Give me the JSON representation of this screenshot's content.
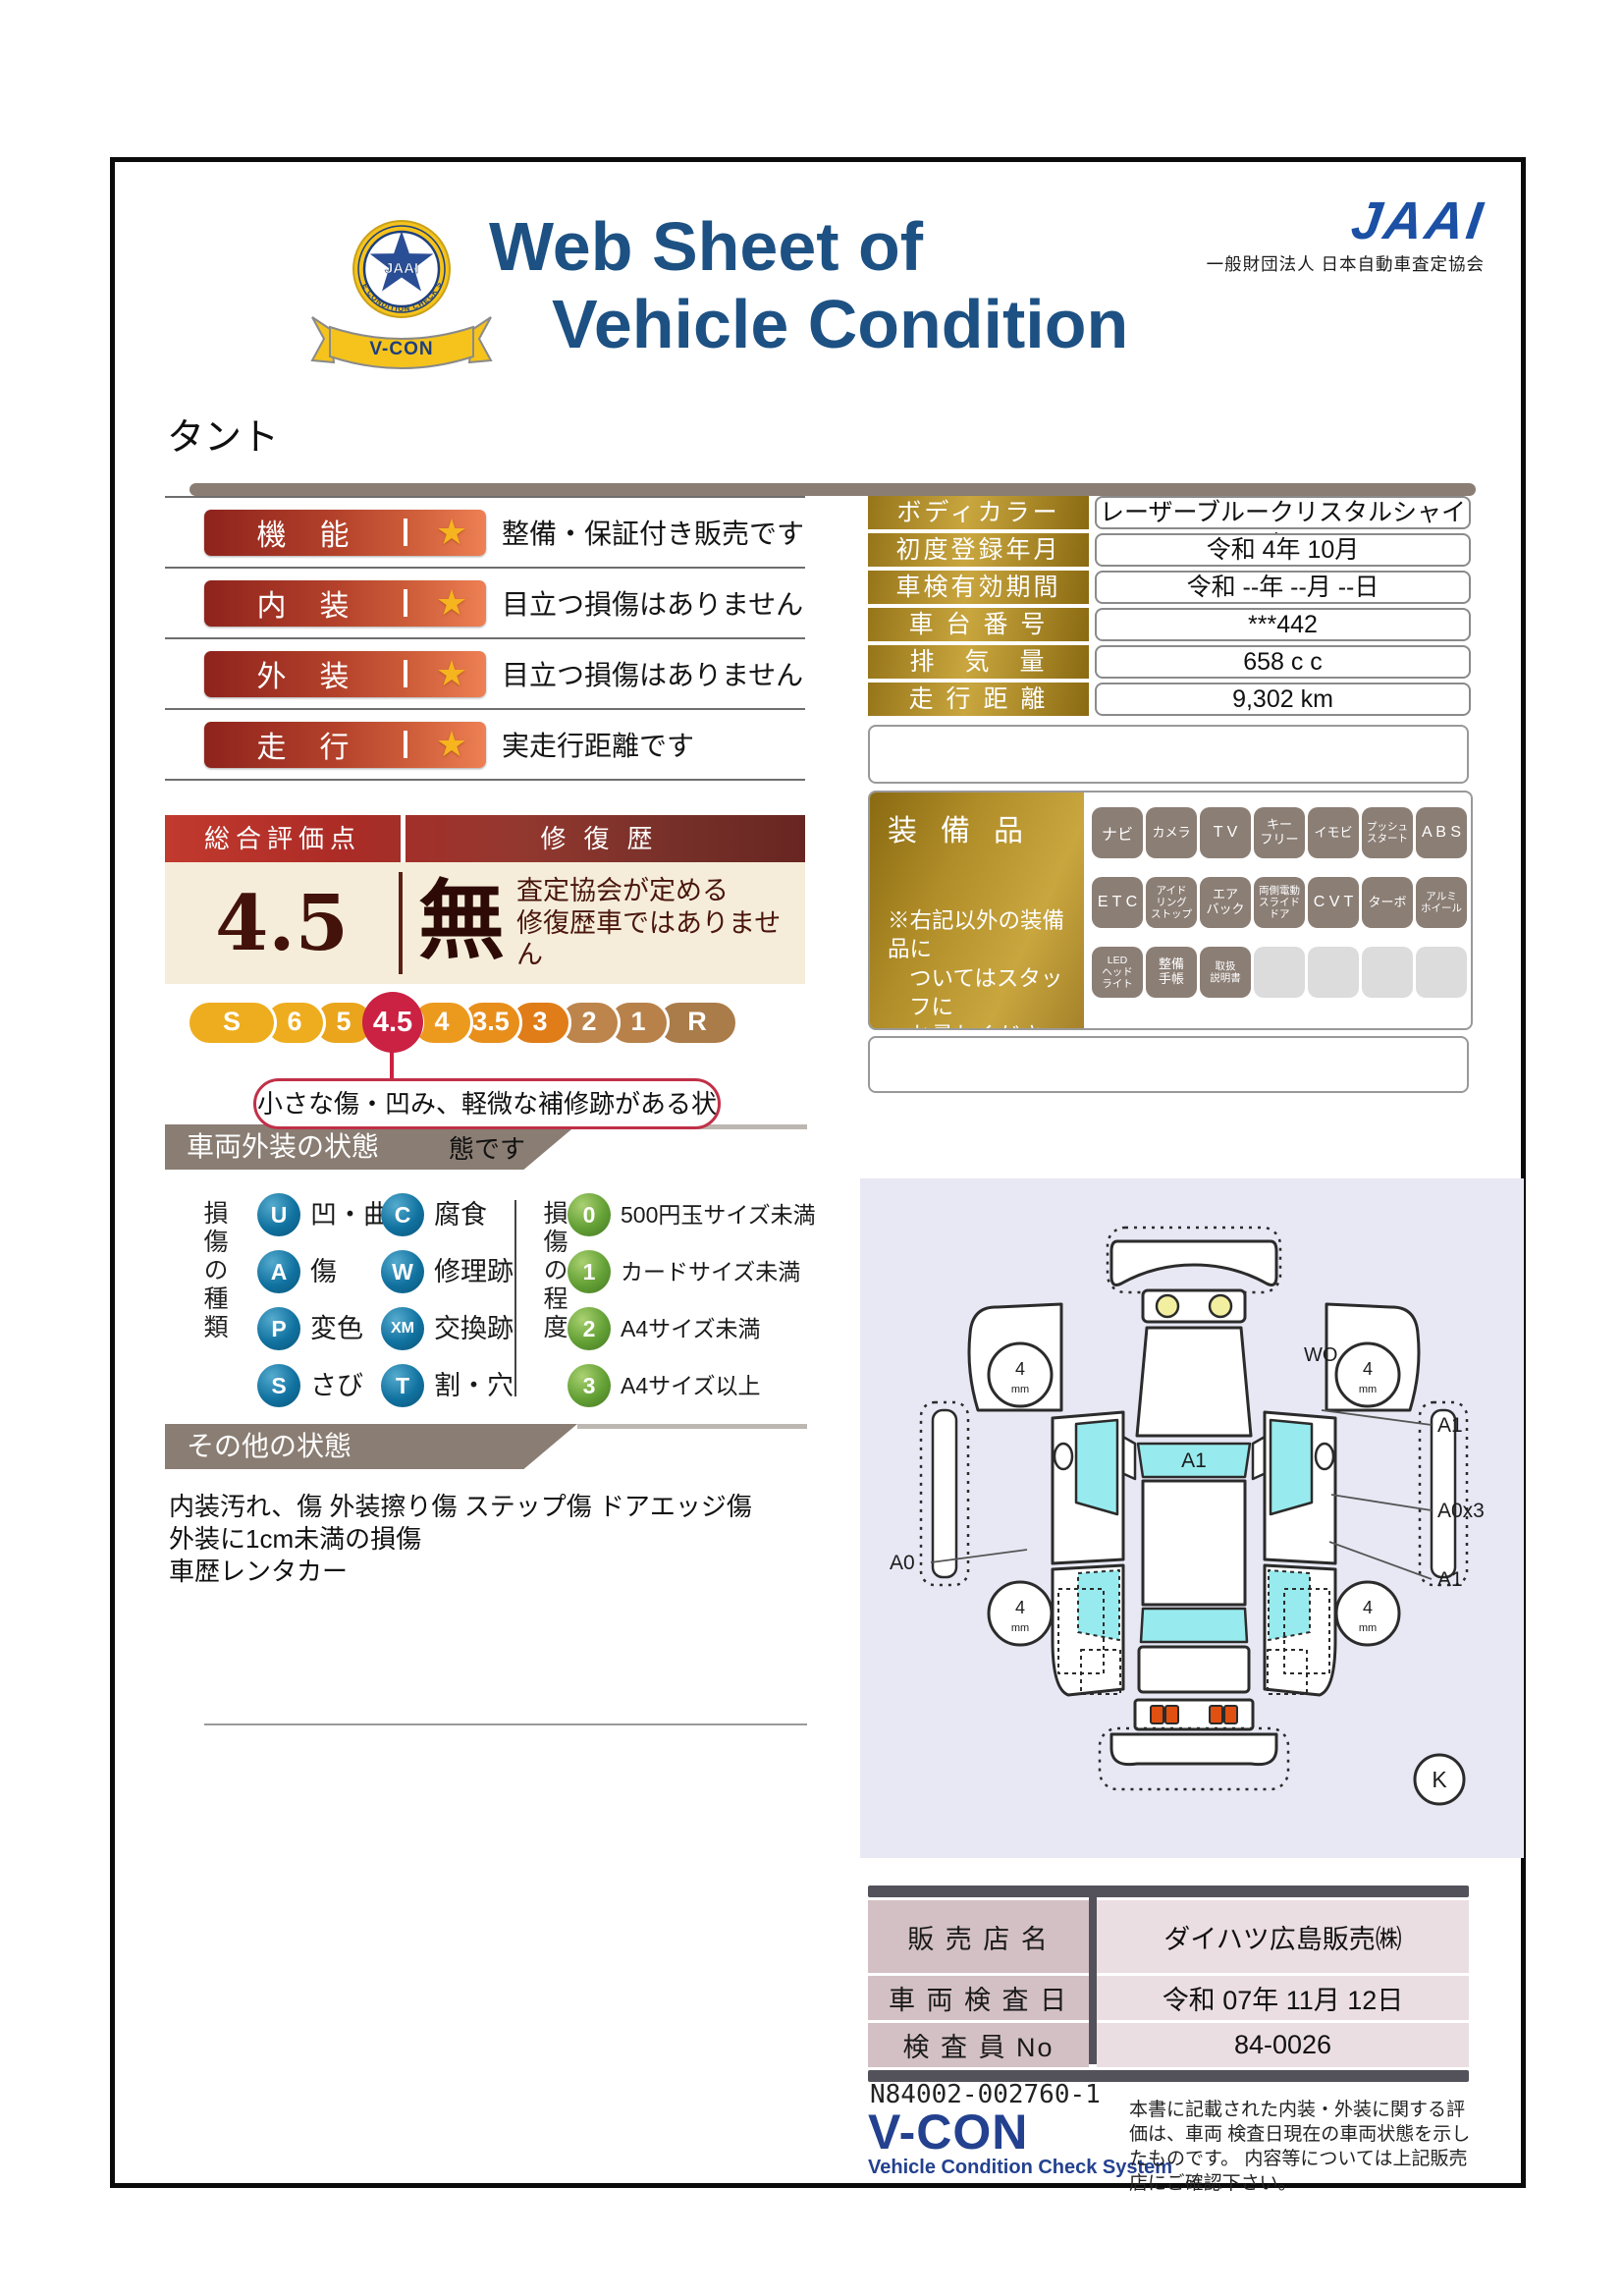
{
  "header": {
    "title_line1": "Web Sheet of",
    "title_line2": "Vehicle Condition",
    "jaai_logo": "JAAI",
    "jaai_org": "一般財団法人 日本自動車査定協会",
    "emblem": {
      "arc_text": "VEHICLE CONDITION CHECK SYSTEM",
      "center_text": "JAAI",
      "ribbon_text": "V-CON"
    }
  },
  "model_name": "タント",
  "icons": {
    "star": "★"
  },
  "ratings": [
    {
      "label": "機　能",
      "description": "整備・保証付き販売です"
    },
    {
      "label": "内　装",
      "description": "目立つ損傷はありません"
    },
    {
      "label": "外　装",
      "description": "目立つ損傷はありません"
    },
    {
      "label": "走　行",
      "description": "実走行距離です"
    }
  ],
  "vehicle_info": [
    {
      "label": "ボディカラー",
      "value": "レーザーブルークリスタルシャイン"
    },
    {
      "label": "初度登録年月",
      "value": "令和 4年 10月"
    },
    {
      "label": "車検有効期間",
      "value": "令和 --年 --月 --日"
    },
    {
      "label": "車 台 番 号",
      "value": "***442"
    },
    {
      "label": "排　気　量",
      "value": "658 c c"
    },
    {
      "label": "走 行 距 離",
      "value": "9,302 km"
    }
  ],
  "overall": {
    "header_left": "総合評価点",
    "header_right": "修復歴",
    "score": "4.5",
    "repair_flag": "無",
    "repair_line1": "査定協会が定める",
    "repair_line2": "修復歴車ではありません",
    "scale": [
      "S",
      "6",
      "5",
      "4.5",
      "4",
      "3.5",
      "3",
      "2",
      "1",
      "R"
    ],
    "selected": "4.5",
    "callout": "小さな傷・凹み、軽微な補修跡がある状態です"
  },
  "equipment": {
    "label": "装備品",
    "note_line1": "※右記以外の装備品に",
    "note_line2": "ついてはスタッフに",
    "note_line3": "お尋ねください。",
    "items": [
      "ナビ",
      "カメラ",
      "T V",
      "キー\nフリー",
      "イモビ",
      "プッシュ\nスタート",
      "A B S",
      "E T C",
      "アイド\nリング\nストップ",
      "エア\nバック",
      "両側電動\nスライド\nドア",
      "C V T",
      "ターボ",
      "アルミ\nホイール",
      "LED\nヘッド\nライト",
      "整備\n手帳",
      "取扱\n説明書"
    ]
  },
  "exterior_section": {
    "title": "車両外装の状態",
    "types_title": "損傷の種類",
    "degrees_title": "損傷の程度",
    "types": [
      {
        "code": "U",
        "label": "凹・曲"
      },
      {
        "code": "C",
        "label": "腐食"
      },
      {
        "code": "A",
        "label": "傷"
      },
      {
        "code": "W",
        "label": "修理跡"
      },
      {
        "code": "P",
        "label": "変色"
      },
      {
        "code": "XM",
        "label": "交換跡"
      },
      {
        "code": "S",
        "label": "さび"
      },
      {
        "code": "T",
        "label": "割・穴"
      }
    ],
    "degrees": [
      {
        "code": "0",
        "label": "500円玉サイズ未満"
      },
      {
        "code": "1",
        "label": "カードサイズ未満"
      },
      {
        "code": "2",
        "label": "A4サイズ未満"
      },
      {
        "code": "3",
        "label": "A4サイズ以上"
      }
    ]
  },
  "other_section": {
    "title": "その他の状態",
    "line1": "内装汚れ、傷 外装擦り傷 ステップ傷 ドアエッジ傷",
    "line2": "外装に1cm未満の損傷",
    "line3": "車歴レンタカー"
  },
  "diagram": {
    "windshield_label": "A1",
    "wo_label": "WO",
    "right_top_label": "A1",
    "right_mid_label": "A0x3",
    "right_bottom_label": "A1",
    "left_label": "A0",
    "key_label": "K",
    "tire_value": "4",
    "tire_unit": "mm"
  },
  "dealer": {
    "rows": [
      {
        "label": "販 売 店 名",
        "value": "ダイハツ広島販売㈱"
      },
      {
        "label": "車 両 検 査 日",
        "value": "令和 07年 11月 12日"
      },
      {
        "label": "検 査 員 No",
        "value": "84-0026"
      }
    ]
  },
  "footer": {
    "serial": "N84002-002760-1",
    "vcon": "V-CON",
    "vcon_sub": "Vehicle Condition Check System",
    "disclaimer_line1": "本書に記載された内装・外装に関する評価は、車両",
    "disclaimer_line2": "検査日現在の車両状態を示したものです。",
    "disclaimer_line3": "内容等については上記販売店にご確認下さい。"
  }
}
